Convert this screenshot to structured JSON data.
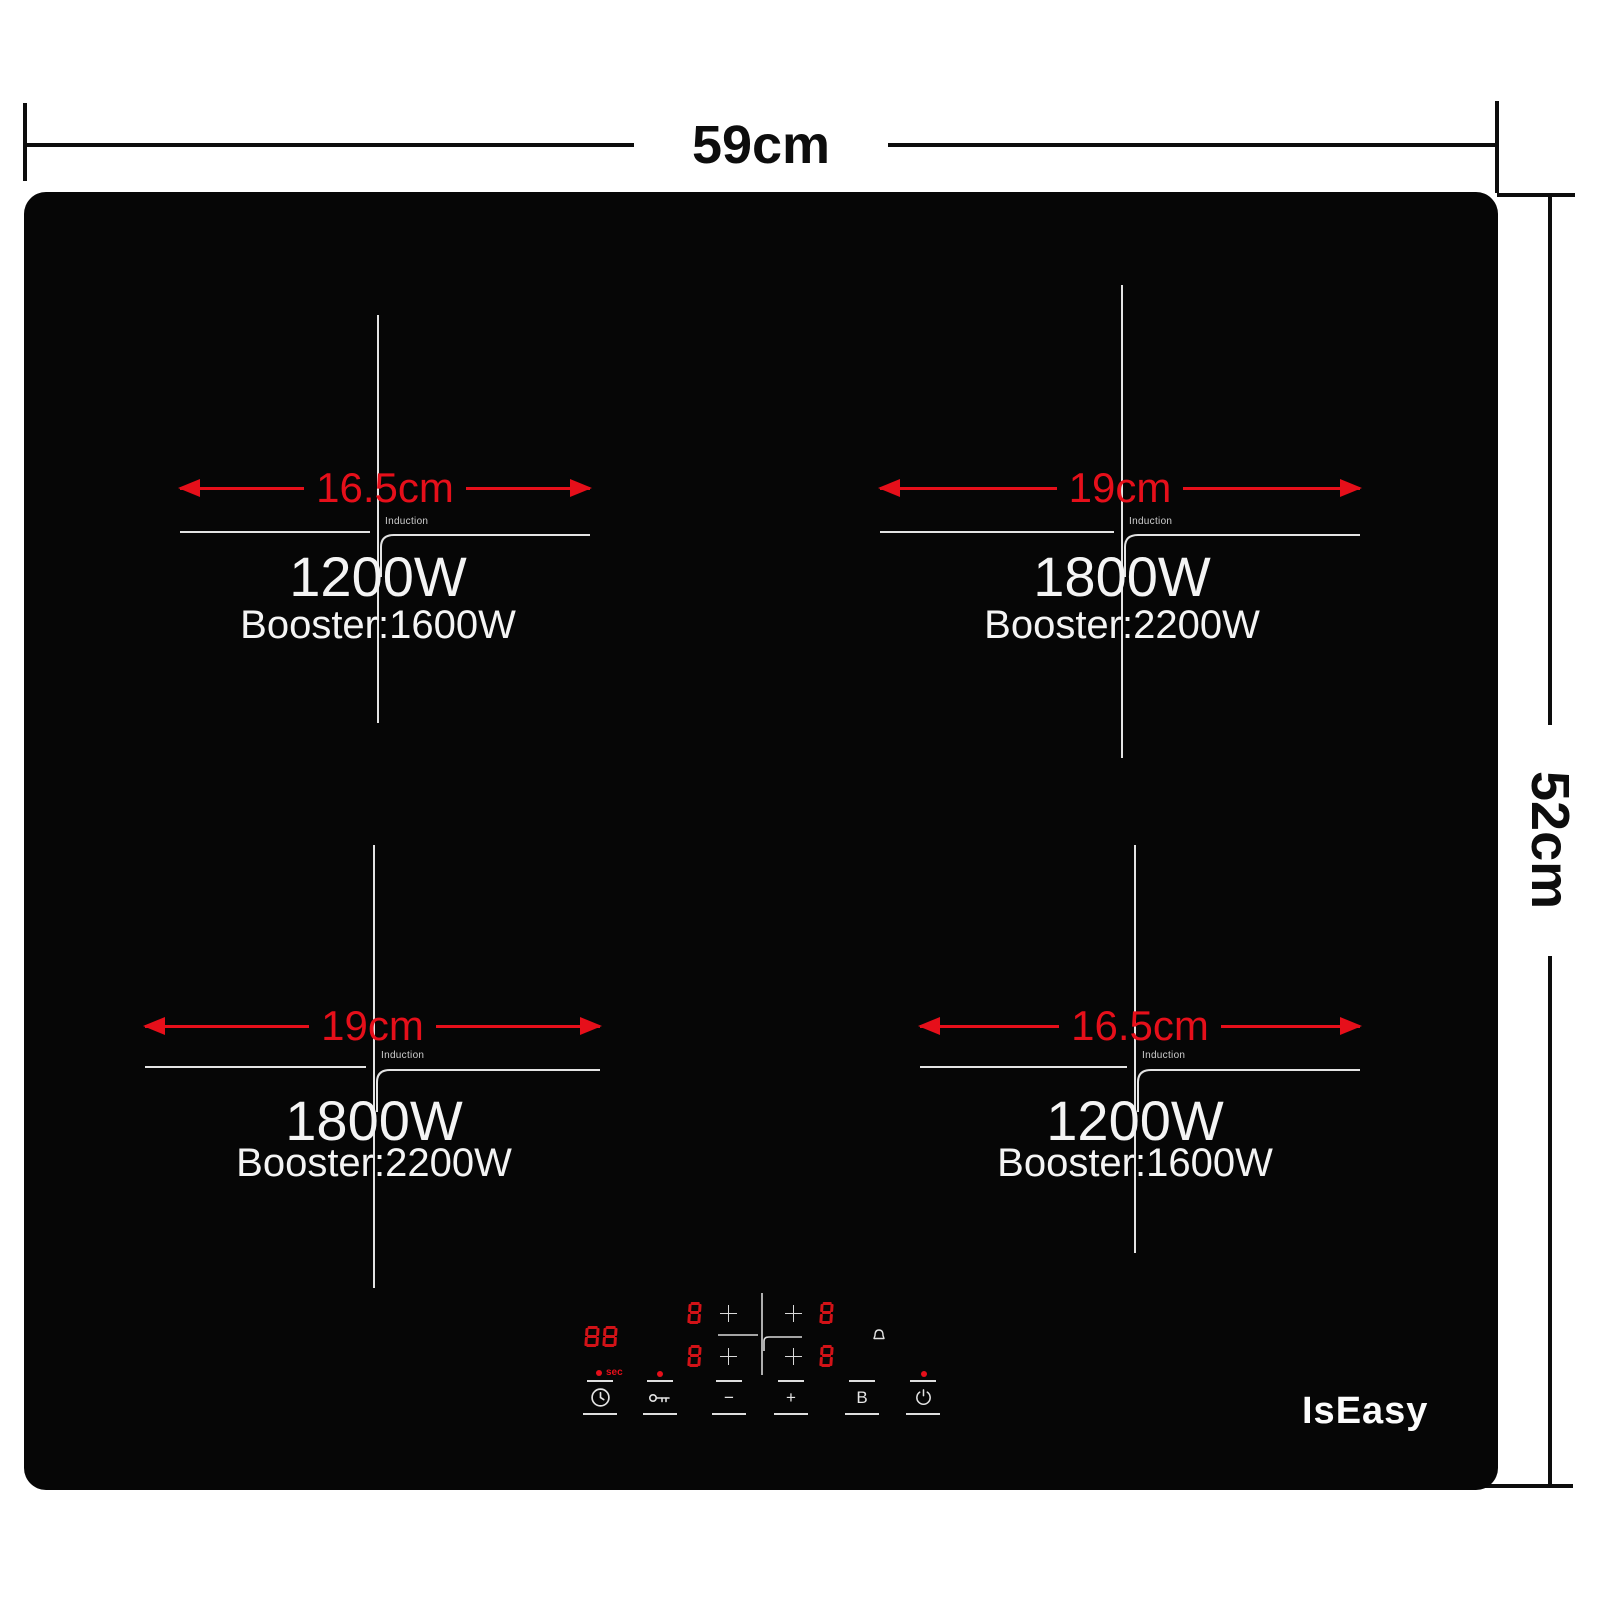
{
  "product": {
    "brand": "IsEasy"
  },
  "dimensions": {
    "width": "59cm",
    "height": "52cm"
  },
  "burners": [
    {
      "position": "top-left",
      "diameter": "16.5cm",
      "power": "1200W",
      "booster": "Booster:1600W",
      "label": "Induction"
    },
    {
      "position": "top-right",
      "diameter": "19cm",
      "power": "1800W",
      "booster": "Booster:2200W",
      "label": "Induction"
    },
    {
      "position": "bottom-left",
      "diameter": "19cm",
      "power": "1800W",
      "booster": "Booster:2200W",
      "label": "Induction"
    },
    {
      "position": "bottom-right",
      "diameter": "16.5cm",
      "power": "1200W",
      "booster": "Booster:1600W",
      "label": "Induction"
    }
  ],
  "control_panel": {
    "timer_display": "88",
    "timer_unit": "sec",
    "zone_displays": [
      "8",
      "8",
      "8",
      "8"
    ],
    "buttons": {
      "timer": {
        "icon": "clock-icon"
      },
      "lock": {
        "icon": "key-icon"
      },
      "minus": {
        "label": "−"
      },
      "plus": {
        "label": "+"
      },
      "booster": {
        "label": "B"
      },
      "power": {
        "icon": "power-icon"
      }
    }
  },
  "colors": {
    "accent_red": "#e60f1a",
    "segment_red": "#d21217",
    "panel_black": "#060606",
    "line_white": "#e3e3e3"
  }
}
